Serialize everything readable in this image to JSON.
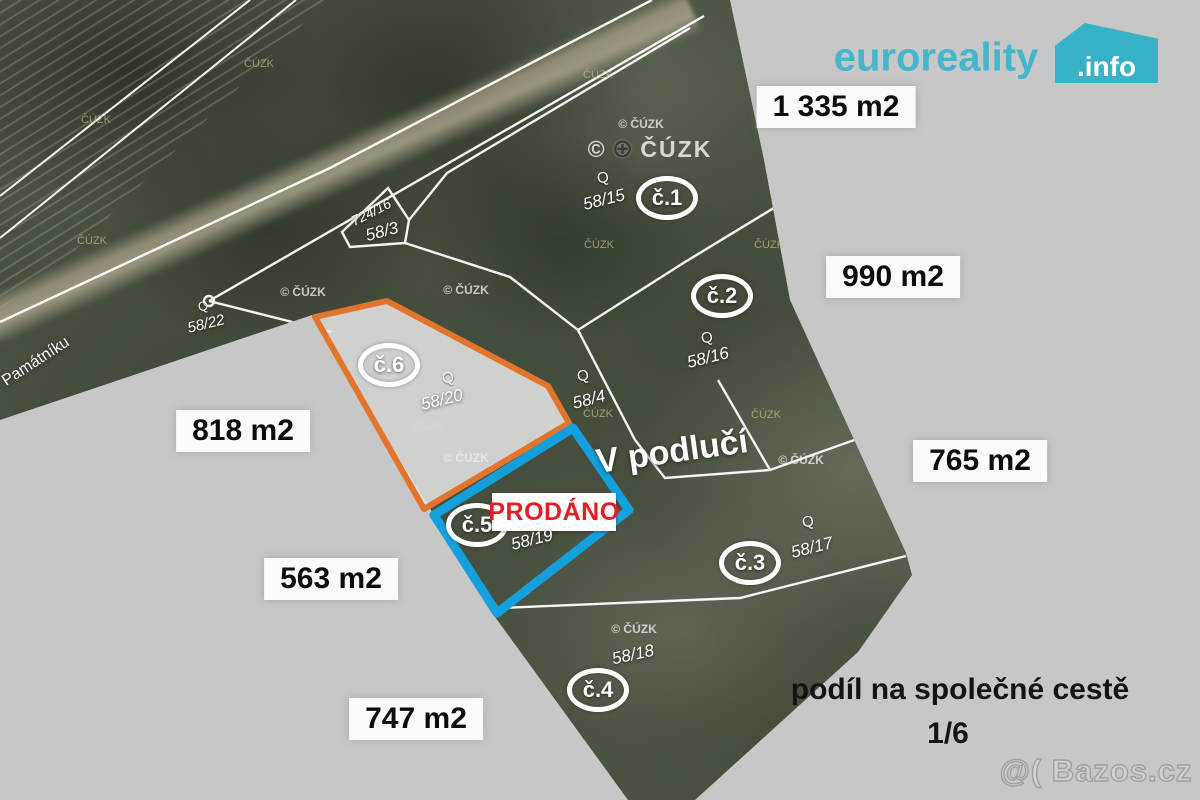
{
  "branding": {
    "logo_name": "euroreality",
    "logo_tld": ".info",
    "logo_color": "#3db5ca",
    "photo_watermark": "@( Bazos.cz"
  },
  "icons": {
    "globe": "⊕"
  },
  "map": {
    "copyright_symbol": "©",
    "copyright_text": "ČÚZK",
    "copyright_full": "© ČÚZK",
    "orchard_symbol": "Q",
    "street_label": "V podlučí",
    "road_label": "Památníku",
    "sold_label": "PRODÁNO",
    "share_note_line1": "podíl na společné cestě",
    "share_note_line2": "1/6",
    "circle_labels": [
      "č.1",
      "č.2",
      "č.3",
      "č.4",
      "č.5",
      "č.6"
    ],
    "parcel_labels": [
      "58/15",
      "58/16",
      "58/17",
      "58/18",
      "58/19",
      "58/20",
      "58/22",
      "58/4",
      "58/3",
      "724/16"
    ],
    "area_labels": [
      "1 335 m2",
      "990 m2",
      "818 m2",
      "765 m2",
      "563 m2",
      "747 m2"
    ],
    "colors": {
      "highlight_plot_outline": "#e2752b",
      "sold_plot_outline": "#14a0dc",
      "sold_text": "#e31e24",
      "background_mask": "#c7c7c7"
    }
  }
}
